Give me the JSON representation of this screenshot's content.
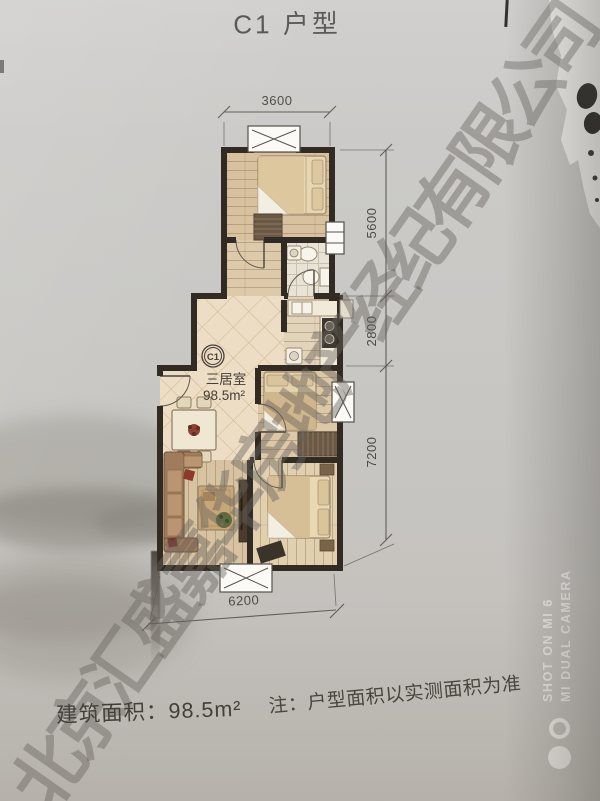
{
  "page": {
    "title": "C1 户型",
    "footer": {
      "area_text": "建筑面积：98.5m²",
      "note_text": "注：户型面积以实测面积为准"
    },
    "watermark_text": "北京汇盛嘉华房地产经纪有限公司",
    "camera_watermark": {
      "line1": "SHOT ON MI 6",
      "line2": "MI DUAL CAMERA"
    }
  },
  "floorplan": {
    "unit_code": "C1",
    "layout_type": "三居室",
    "area": "98.5m²",
    "dimensions": {
      "top_width": "3600",
      "right_upper": "5600",
      "right_middle": "2800",
      "right_lower": "7200",
      "bottom_width": "6200"
    },
    "colors": {
      "wall": "#322b24",
      "tile_floor": "#ecddc4",
      "wood_floor": "#d7c19e",
      "dimension_text": "#4e4b46"
    }
  }
}
